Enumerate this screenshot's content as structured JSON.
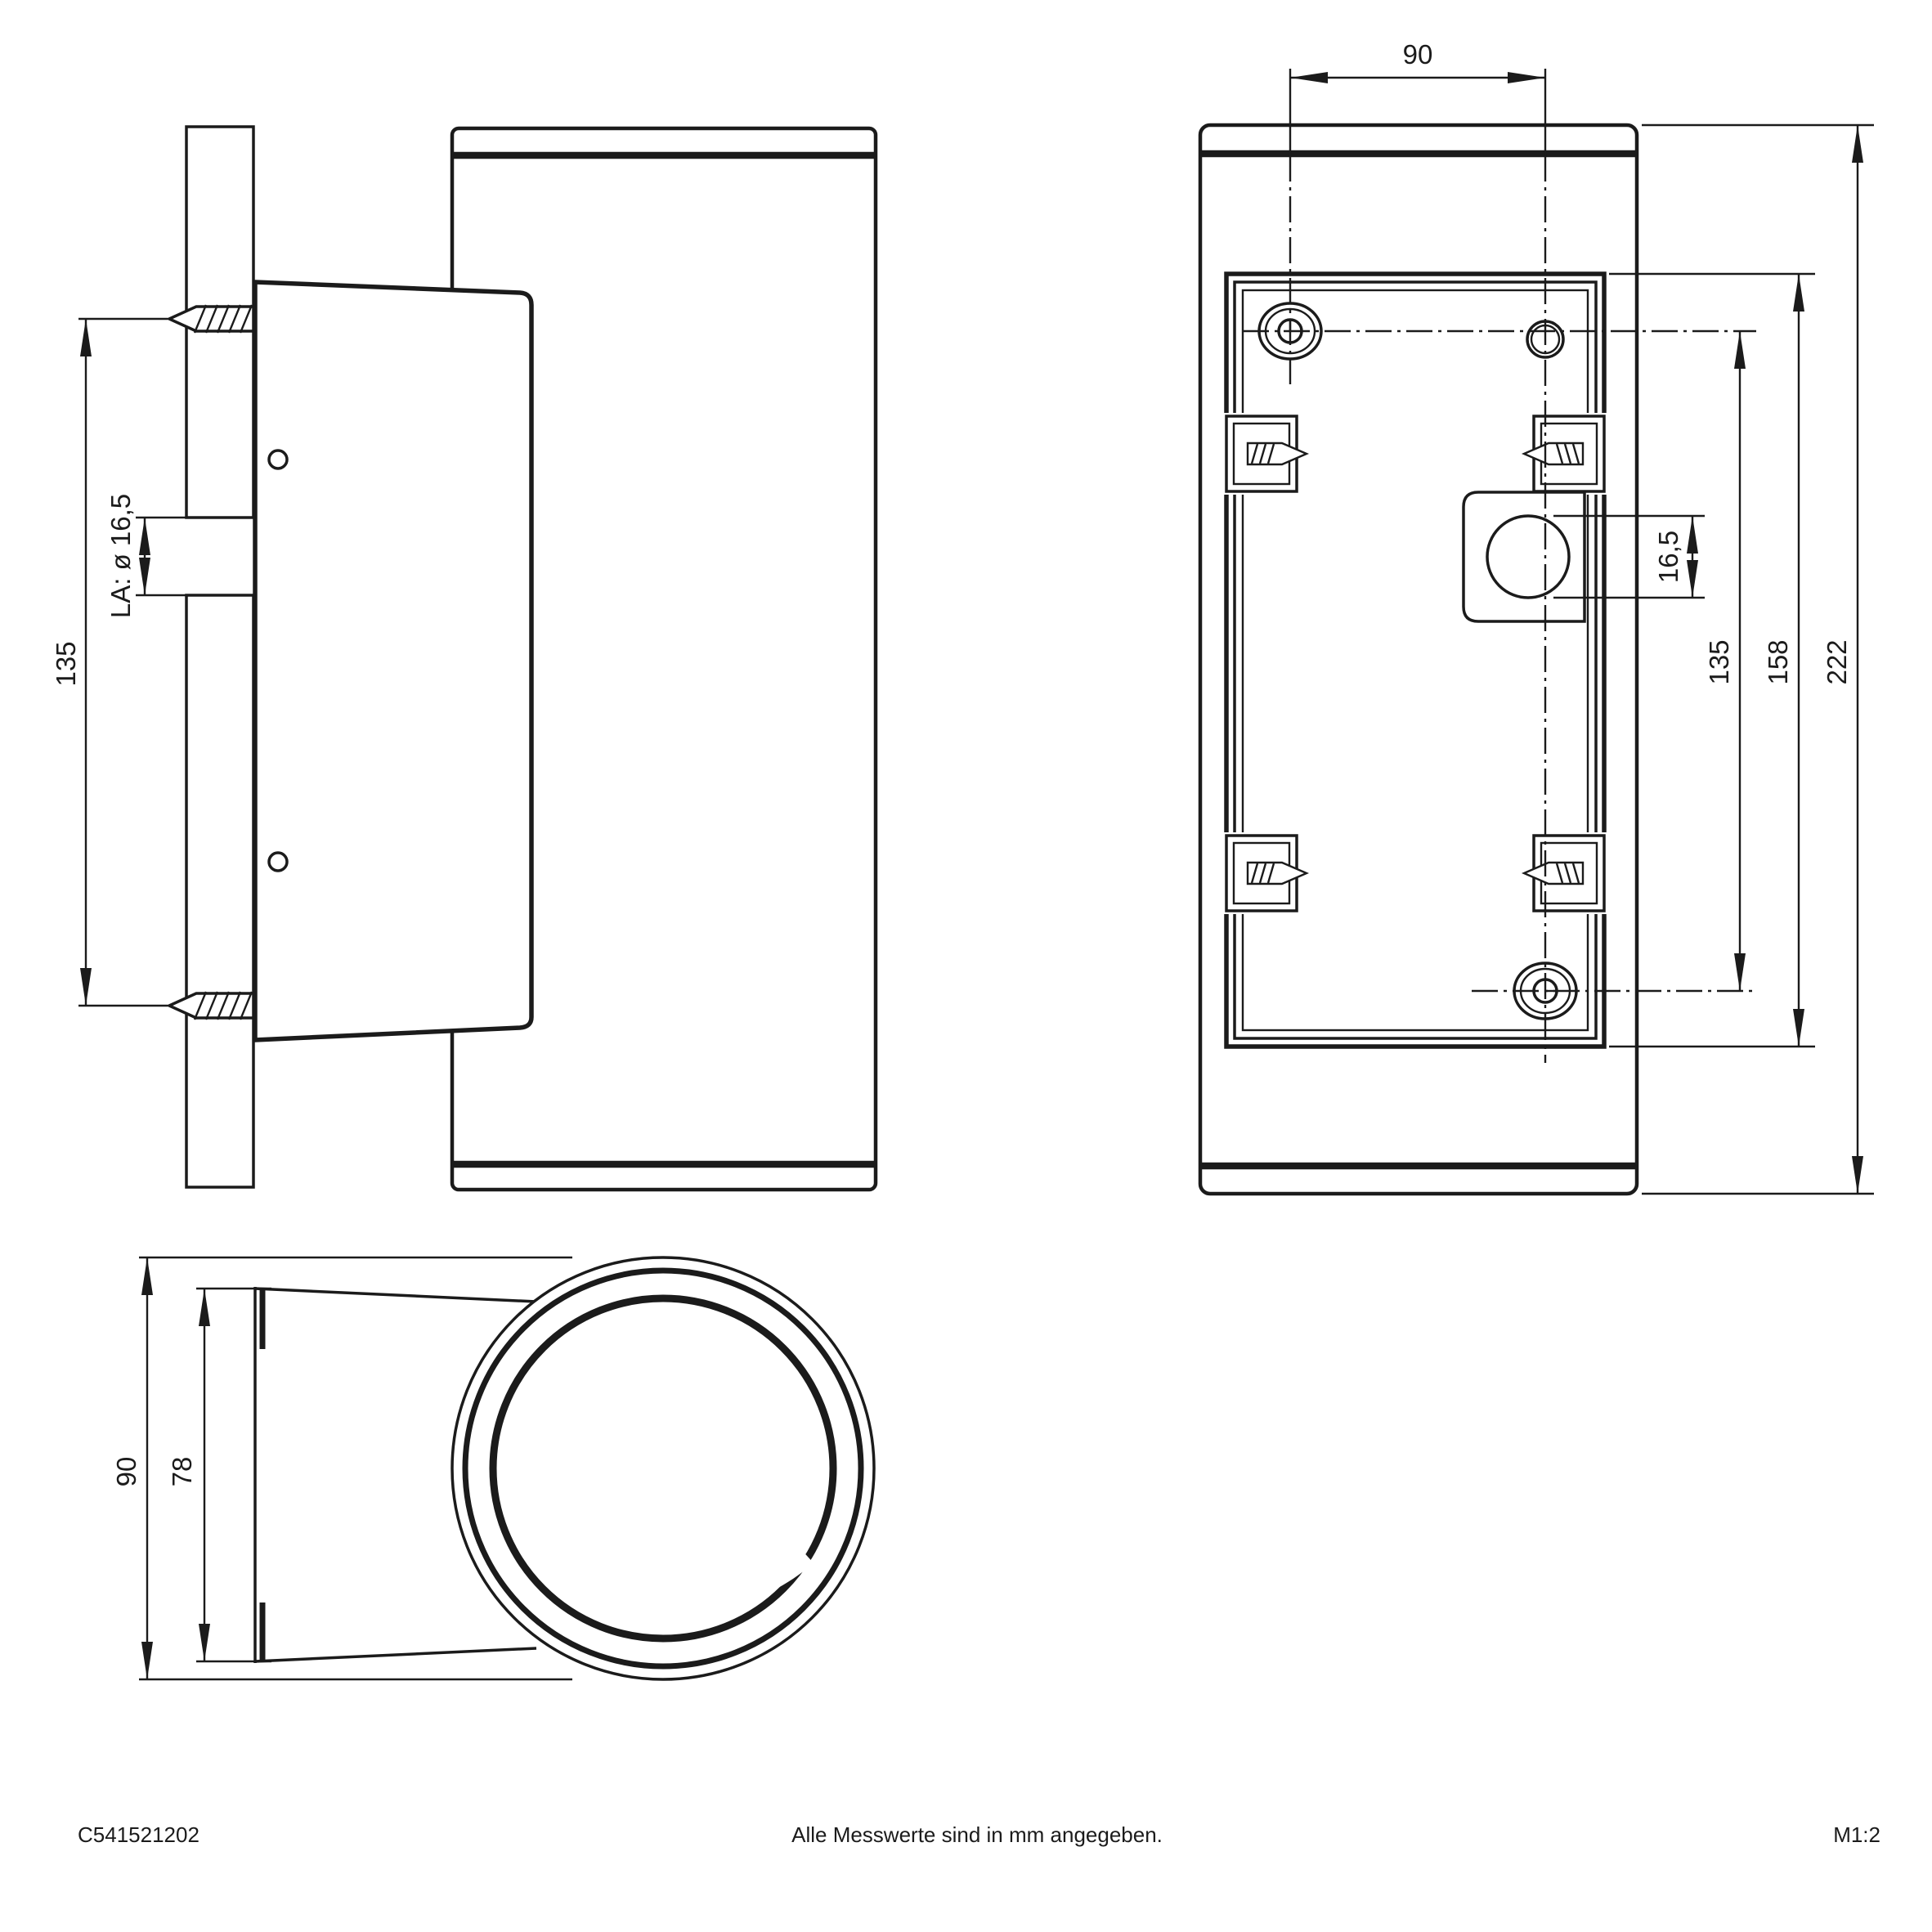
{
  "colors": {
    "line": "#1b1b1b",
    "glass": "#e8e8e8",
    "background": "#ffffff"
  },
  "side_view": {
    "hole_spacing": "135",
    "cable_hole_label": "LA: ø 16,5"
  },
  "rear_view": {
    "hole_spacing_horizontal": "90",
    "cable_hole_diameter": "16,5",
    "hole_spacing_vertical": "135",
    "plate_height": "158",
    "total_height": "222"
  },
  "top_view": {
    "overall_diameter": "90",
    "plate_depth": "78"
  },
  "footer": {
    "article_number": "C541521202",
    "note": "Alle Messwerte sind in mm angegeben.",
    "scale_label": "M1:2"
  }
}
